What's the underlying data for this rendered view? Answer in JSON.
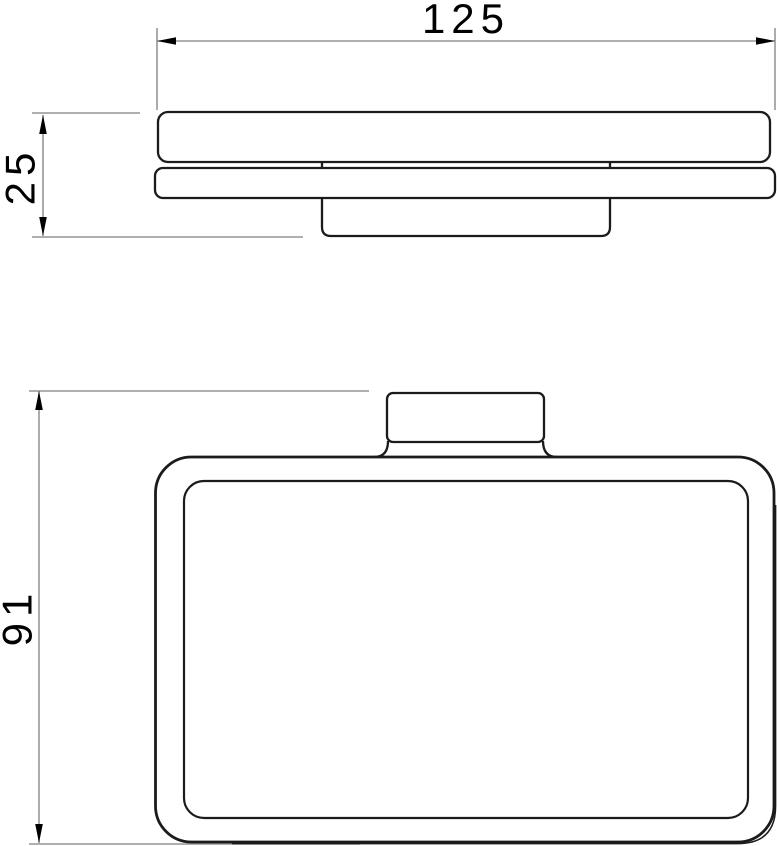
{
  "colors": {
    "background": "#ffffff",
    "object_line": "#1b1b1b",
    "dimension_line": "#7f7f7f",
    "dimension_text": "#000000"
  },
  "top_view": {
    "width_dimension": {
      "label": "125"
    },
    "thickness_dimension": {
      "label": "25"
    }
  },
  "front_view": {
    "height_dimension": {
      "label": "91"
    }
  }
}
